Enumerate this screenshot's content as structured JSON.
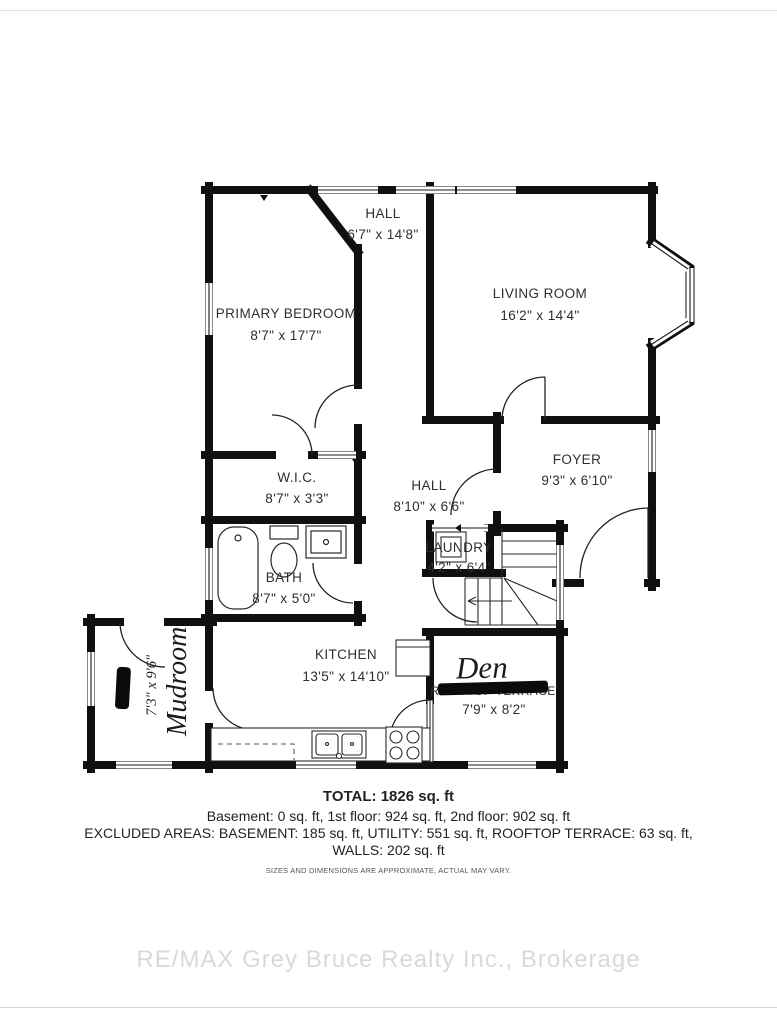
{
  "floorplan": {
    "rooms": [
      {
        "id": "hall-upper",
        "name": "HALL",
        "dims": "6'7\" x 14'8\""
      },
      {
        "id": "living-room",
        "name": "LIVING ROOM",
        "dims": "16'2\" x 14'4\""
      },
      {
        "id": "primary-bedroom",
        "name": "PRIMARY BEDROOM",
        "dims": "8'7\" x 17'7\""
      },
      {
        "id": "wic",
        "name": "W.I.C.",
        "dims": "8'7\" x 3'3\""
      },
      {
        "id": "hall-lower",
        "name": "HALL",
        "dims": "8'10\" x 6'6\""
      },
      {
        "id": "foyer",
        "name": "FOYER",
        "dims": "9'3\" x 6'10\""
      },
      {
        "id": "laundry",
        "name": "LAUNDRY",
        "dims": "4'2\" x 6'4\""
      },
      {
        "id": "bath",
        "name": "BATH",
        "dims": "8'7\" x 5'0\""
      },
      {
        "id": "kitchen",
        "name": "KITCHEN",
        "dims": "13'5\" x 14'10\""
      },
      {
        "id": "den",
        "name": "Den",
        "struck_label": "ROOFTOP TERRACE",
        "dims": "7'9\" x 8'2\""
      },
      {
        "id": "mudroom",
        "name": "Mudroom",
        "dims": "7'3\" x 9'6\""
      }
    ]
  },
  "summary": {
    "total": "TOTAL: 1826 sq. ft",
    "floors": "Basement: 0 sq. ft, 1st floor: 924 sq. ft, 2nd floor: 902 sq. ft",
    "excluded": "EXCLUDED AREAS: BASEMENT: 185 sq. ft, UTILITY: 551 sq. ft, ROOFTOP TERRACE: 63 sq. ft,",
    "walls": "WALLS: 202 sq. ft",
    "disclaimer": "SIZES AND DIMENSIONS ARE APPROXIMATE, ACTUAL MAY VARY."
  },
  "page": {
    "watermark": "RE/MAX Grey Bruce Realty Inc., Brokerage"
  }
}
